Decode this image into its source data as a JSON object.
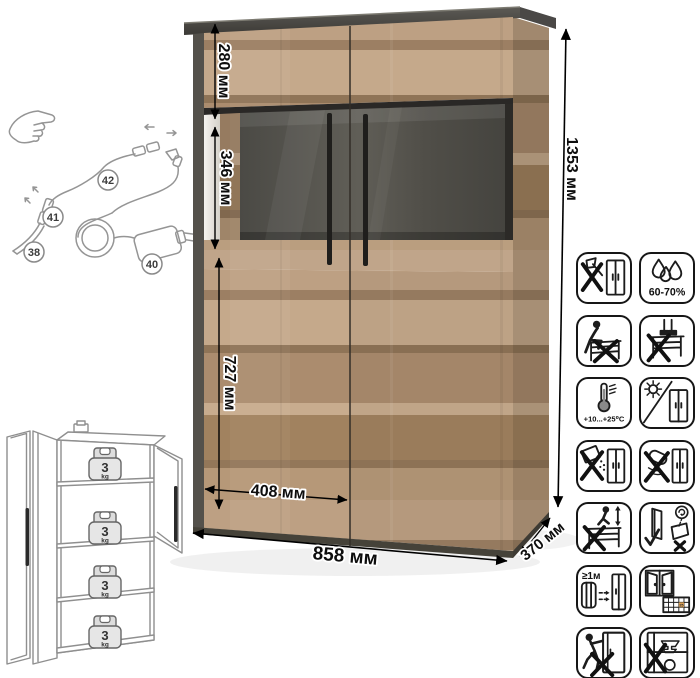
{
  "cabinet_photo": {
    "dimensions": {
      "top_section": "280 мм",
      "glass_section": "346 мм",
      "lower_section": "727 мм",
      "door_width": "408 мм",
      "overall_width": "858 мм",
      "depth": "370 мм",
      "overall_height": "1353 мм"
    },
    "colors": {
      "wood_light": "#c5a98b",
      "wood_base": "#b3947a",
      "wood_dark": "#8f7457",
      "frame_graphite": "#4c4a45",
      "glass_back": "#54524c",
      "handle_black": "#1f1e1c"
    }
  },
  "led_kit": {
    "labels": {
      "led_strip": "38",
      "power_adapter": "40",
      "connector": "41",
      "cable": "42"
    }
  },
  "shelf_load": {
    "weights": [
      {
        "value": "3",
        "unit": "kg"
      },
      {
        "value": "3",
        "unit": "kg"
      },
      {
        "value": "3",
        "unit": "kg"
      },
      {
        "value": "3",
        "unit": "kg"
      }
    ]
  },
  "care_grid": {
    "tiles": [
      {
        "name": "no-sharp-tools"
      },
      {
        "name": "humidity-range",
        "text": "60-70%"
      },
      {
        "name": "no-sitting"
      },
      {
        "name": "no-standing"
      },
      {
        "name": "temperature-range",
        "text": "+10...+25⁰C"
      },
      {
        "name": "avoid-direct-sunlight"
      },
      {
        "name": "no-abrasive-powders"
      },
      {
        "name": "no-wet-scrubbing"
      },
      {
        "name": "no-jumping"
      },
      {
        "name": "carry-panels-upright"
      },
      {
        "name": "keep-1m-from-heaters",
        "text": "≥1м"
      },
      {
        "name": "ventilate-room",
        "date": "25"
      },
      {
        "name": "no-dragging"
      },
      {
        "name": "no-heavy-items"
      }
    ]
  }
}
